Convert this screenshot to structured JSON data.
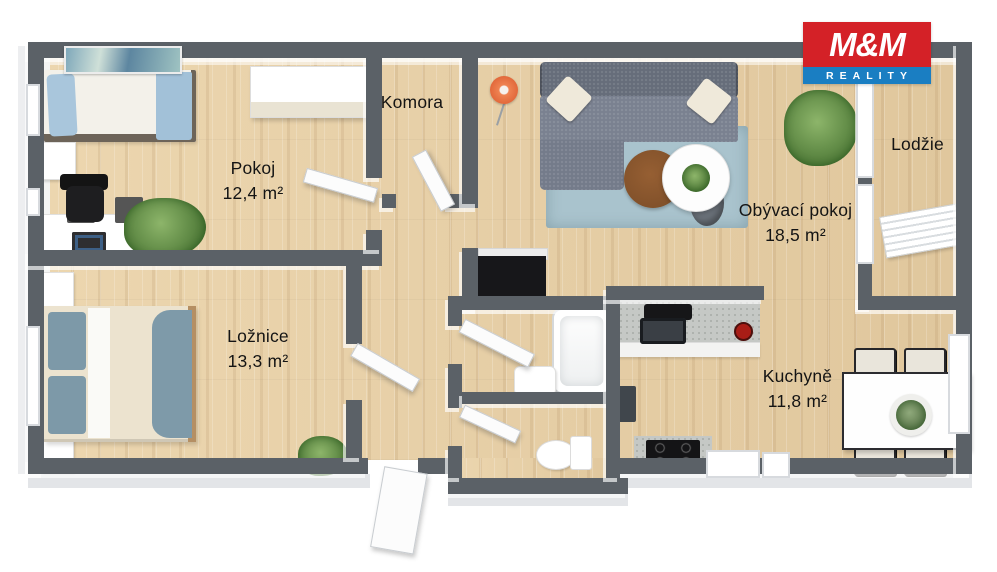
{
  "company_logo": {
    "top": "M&M",
    "bottom": "REALITY"
  },
  "rooms": {
    "pokoj": {
      "name": "Pokoj",
      "area": "12,4 m²"
    },
    "komora": {
      "name": "Komora"
    },
    "obyvaci": {
      "name": "Obývací pokoj",
      "area": "18,5 m²"
    },
    "lodzie": {
      "name": "Lodžie"
    },
    "loznice": {
      "name": "Ložnice",
      "area": "13,3 m²"
    },
    "kuchyne": {
      "name": "Kuchyně",
      "area": "11,8 m²"
    }
  },
  "colors": {
    "wall": "#5b6167",
    "floor_wood": "#e6cfa7",
    "logo_red": "#d42127",
    "logo_blue": "#1a7ec2",
    "rug": "#a9c3cd",
    "sofa": "#7a8190"
  }
}
